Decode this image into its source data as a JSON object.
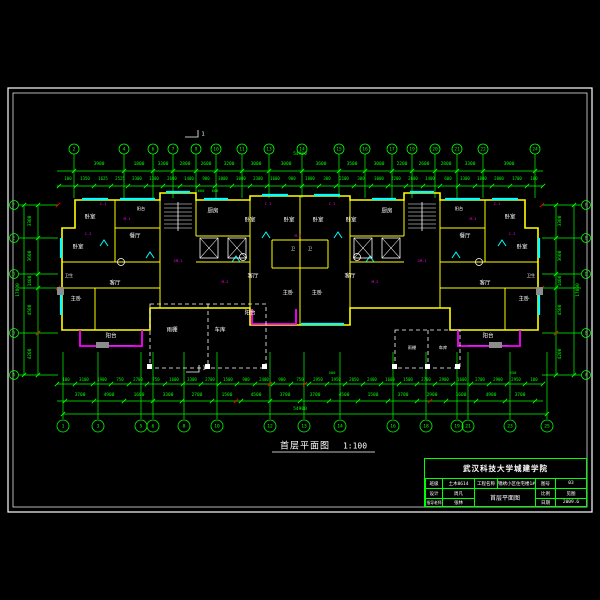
{
  "drawing_title": {
    "name": "首层平面图",
    "scale": "1:100"
  },
  "title_block": {
    "school": "武汉科技大学城建学院",
    "r1c1": "班级",
    "r1v1": "土木0614",
    "r1c2": "工程名称",
    "r1v2": "锦绣小区住宅楼1#",
    "r1c3": "图号",
    "r1v3": "03",
    "r2c1": "设计",
    "r2v1": "周凡",
    "big": "首层平面图",
    "r2c3": "比例",
    "r2v3": "见图",
    "r3c1": "指导老师",
    "r3v1": "张林",
    "r3c3": "日期",
    "r3v3": "2009.6"
  },
  "colors": {
    "axis": "#00ff00",
    "wall": "#ffff00",
    "window": "#00ffff",
    "balcony": "#ff00ff",
    "text": "#ffffff",
    "tag": "#ff00ff",
    "red": "#ff0000",
    "bg": "#000000"
  },
  "texts": [
    {
      "t": "3900",
      "x": 99,
      "y": 165
    },
    {
      "t": "1800",
      "x": 139,
      "y": 165
    },
    {
      "t": "3300",
      "x": 163,
      "y": 165
    },
    {
      "t": "2800",
      "x": 185,
      "y": 165
    },
    {
      "t": "2600",
      "x": 206,
      "y": 165
    },
    {
      "t": "3200",
      "x": 229,
      "y": 165
    },
    {
      "t": "3000",
      "x": 256,
      "y": 165
    },
    {
      "t": "3000",
      "x": 286,
      "y": 165
    },
    {
      "t": "3600",
      "x": 321,
      "y": 165
    },
    {
      "t": "3500",
      "x": 352,
      "y": 165
    },
    {
      "t": "3000",
      "x": 379,
      "y": 165
    },
    {
      "t": "2200",
      "x": 402,
      "y": 165
    },
    {
      "t": "2600",
      "x": 424,
      "y": 165
    },
    {
      "t": "2800",
      "x": 446,
      "y": 165
    },
    {
      "t": "3300",
      "x": 470,
      "y": 165
    },
    {
      "t": "3900",
      "x": 509,
      "y": 165
    },
    {
      "t": "100",
      "x": 68,
      "y": 179,
      "s": 4
    },
    {
      "t": "1350",
      "x": 85,
      "y": 179,
      "s": 4
    },
    {
      "t": "1625",
      "x": 103,
      "y": 179,
      "s": 4
    },
    {
      "t": "2525",
      "x": 120,
      "y": 179,
      "s": 4
    },
    {
      "t": "3300",
      "x": 137,
      "y": 179,
      "s": 4
    },
    {
      "t": "1300",
      "x": 154,
      "y": 179,
      "s": 4
    },
    {
      "t": "2600",
      "x": 172,
      "y": 179,
      "s": 4
    },
    {
      "t": "1400",
      "x": 189,
      "y": 179,
      "s": 4
    },
    {
      "t": "900",
      "x": 206,
      "y": 179,
      "s": 4
    },
    {
      "t": "3000",
      "x": 223,
      "y": 179,
      "s": 4
    },
    {
      "t": "3000",
      "x": 241,
      "y": 179,
      "s": 4
    },
    {
      "t": "2300",
      "x": 258,
      "y": 179,
      "s": 4
    },
    {
      "t": "1600",
      "x": 275,
      "y": 179,
      "s": 4
    },
    {
      "t": "900",
      "x": 292,
      "y": 179,
      "s": 4
    },
    {
      "t": "1800",
      "x": 310,
      "y": 179,
      "s": 4
    },
    {
      "t": "300",
      "x": 327,
      "y": 179,
      "s": 4
    },
    {
      "t": "2100",
      "x": 344,
      "y": 179,
      "s": 4
    },
    {
      "t": "300",
      "x": 361,
      "y": 179,
      "s": 4
    },
    {
      "t": "3000",
      "x": 379,
      "y": 179,
      "s": 4
    },
    {
      "t": "2200",
      "x": 396,
      "y": 179,
      "s": 4
    },
    {
      "t": "2600",
      "x": 413,
      "y": 179,
      "s": 4
    },
    {
      "t": "1400",
      "x": 430,
      "y": 179,
      "s": 4
    },
    {
      "t": "600",
      "x": 448,
      "y": 179,
      "s": 4
    },
    {
      "t": "3300",
      "x": 465,
      "y": 179,
      "s": 4
    },
    {
      "t": "1800",
      "x": 482,
      "y": 179,
      "s": 4
    },
    {
      "t": "2800",
      "x": 499,
      "y": 179,
      "s": 4
    },
    {
      "t": "1700",
      "x": 517,
      "y": 179,
      "s": 4
    },
    {
      "t": "100",
      "x": 534,
      "y": 179,
      "s": 4
    },
    {
      "t": "54900",
      "x": 300,
      "y": 155,
      "n": "total-dim"
    },
    {
      "t": "600",
      "x": 201,
      "y": 191,
      "s": 3.8
    },
    {
      "t": "600",
      "x": 215,
      "y": 191,
      "s": 3.8
    },
    {
      "t": "100",
      "x": 66,
      "y": 380,
      "s": 4
    },
    {
      "t": "3100",
      "x": 84,
      "y": 380,
      "s": 4
    },
    {
      "t": "1900",
      "x": 102,
      "y": 380,
      "s": 4
    },
    {
      "t": "750",
      "x": 120,
      "y": 380,
      "s": 4
    },
    {
      "t": "2700",
      "x": 138,
      "y": 380,
      "s": 4
    },
    {
      "t": "750",
      "x": 156,
      "y": 380,
      "s": 4
    },
    {
      "t": "1600",
      "x": 174,
      "y": 380,
      "s": 4
    },
    {
      "t": "3300",
      "x": 192,
      "y": 380,
      "s": 4
    },
    {
      "t": "2700",
      "x": 210,
      "y": 380,
      "s": 4
    },
    {
      "t": "1500",
      "x": 228,
      "y": 380,
      "s": 4
    },
    {
      "t": "900",
      "x": 246,
      "y": 380,
      "s": 4
    },
    {
      "t": "2400",
      "x": 264,
      "y": 380,
      "s": 4
    },
    {
      "t": "900",
      "x": 282,
      "y": 380,
      "s": 4
    },
    {
      "t": "750",
      "x": 300,
      "y": 380,
      "s": 4
    },
    {
      "t": "2950",
      "x": 318,
      "y": 380,
      "s": 4
    },
    {
      "t": "1950",
      "x": 336,
      "y": 380,
      "s": 4
    },
    {
      "t": "2050",
      "x": 354,
      "y": 380,
      "s": 4
    },
    {
      "t": "2400",
      "x": 372,
      "y": 380,
      "s": 4
    },
    {
      "t": "1600",
      "x": 390,
      "y": 380,
      "s": 4
    },
    {
      "t": "1500",
      "x": 408,
      "y": 380,
      "s": 4
    },
    {
      "t": "2700",
      "x": 426,
      "y": 380,
      "s": 4
    },
    {
      "t": "2900",
      "x": 444,
      "y": 380,
      "s": 4
    },
    {
      "t": "1600",
      "x": 462,
      "y": 380,
      "s": 4
    },
    {
      "t": "2700",
      "x": 480,
      "y": 380,
      "s": 4
    },
    {
      "t": "2900",
      "x": 498,
      "y": 380,
      "s": 4
    },
    {
      "t": "2950",
      "x": 516,
      "y": 380,
      "s": 4
    },
    {
      "t": "100",
      "x": 534,
      "y": 380,
      "s": 4
    },
    {
      "t": "500",
      "x": 332,
      "y": 373,
      "s": 3.8
    },
    {
      "t": "650",
      "x": 513,
      "y": 373,
      "s": 3.8
    },
    {
      "t": "3700",
      "x": 80,
      "y": 396
    },
    {
      "t": "4900",
      "x": 109,
      "y": 396
    },
    {
      "t": "1600",
      "x": 139,
      "y": 396
    },
    {
      "t": "3300",
      "x": 168,
      "y": 396
    },
    {
      "t": "2700",
      "x": 197,
      "y": 396
    },
    {
      "t": "1500",
      "x": 227,
      "y": 396
    },
    {
      "t": "4500",
      "x": 256,
      "y": 396
    },
    {
      "t": "3700",
      "x": 285,
      "y": 396
    },
    {
      "t": "3700",
      "x": 315,
      "y": 396
    },
    {
      "t": "4500",
      "x": 344,
      "y": 396
    },
    {
      "t": "1500",
      "x": 373,
      "y": 396
    },
    {
      "t": "3700",
      "x": 403,
      "y": 396
    },
    {
      "t": "2900",
      "x": 432,
      "y": 396
    },
    {
      "t": "1600",
      "x": 461,
      "y": 396
    },
    {
      "t": "4900",
      "x": 491,
      "y": 396
    },
    {
      "t": "3700",
      "x": 520,
      "y": 396
    },
    {
      "t": "54900",
      "x": 300,
      "y": 410,
      "n": "total-dim"
    },
    {
      "t": "3300",
      "x": 31,
      "y": 221,
      "r": 1
    },
    {
      "t": "3600",
      "x": 31,
      "y": 256,
      "r": 1
    },
    {
      "t": "1400",
      "x": 31,
      "y": 281,
      "r": 1
    },
    {
      "t": "4500",
      "x": 31,
      "y": 310,
      "r": 1
    },
    {
      "t": "4200",
      "x": 31,
      "y": 354,
      "r": 1
    },
    {
      "t": "17800",
      "x": 19,
      "y": 290,
      "r": 1,
      "n": "total-dim"
    },
    {
      "t": "3300",
      "x": 561,
      "y": 221,
      "r": 1
    },
    {
      "t": "3600",
      "x": 561,
      "y": 256,
      "r": 1
    },
    {
      "t": "1400",
      "x": 561,
      "y": 281,
      "r": 1
    },
    {
      "t": "4500",
      "x": 561,
      "y": 310,
      "r": 1
    },
    {
      "t": "4200",
      "x": 561,
      "y": 354,
      "r": 1
    },
    {
      "t": "17800",
      "x": 579,
      "y": 290,
      "r": 1,
      "n": "total-dim"
    },
    {
      "t": "卧室",
      "x": 90,
      "y": 218,
      "c": "w",
      "s": 5.5,
      "n": "room-label"
    },
    {
      "t": "卧室",
      "x": 78,
      "y": 248,
      "c": "w",
      "s": 5.5,
      "n": "room-label"
    },
    {
      "t": "卫生",
      "x": 69,
      "y": 276,
      "c": "w",
      "s": 4.2,
      "n": "room-label"
    },
    {
      "t": "主卧",
      "x": 76,
      "y": 300,
      "c": "w",
      "s": 5.5,
      "n": "room-label"
    },
    {
      "t": "餐厅",
      "x": 135,
      "y": 237,
      "c": "w",
      "s": 5.5,
      "n": "room-label"
    },
    {
      "t": "客厅",
      "x": 115,
      "y": 284,
      "c": "w",
      "s": 5.5,
      "n": "room-label"
    },
    {
      "t": "阳台",
      "x": 111,
      "y": 337,
      "c": "w",
      "s": 5.5,
      "n": "room-label"
    },
    {
      "t": "阳台",
      "x": 141,
      "y": 209,
      "c": "w",
      "s": 4.2,
      "n": "room-label"
    },
    {
      "t": "厨房",
      "x": 213,
      "y": 212,
      "c": "w",
      "s": 5.5,
      "n": "room-label"
    },
    {
      "t": "卧室",
      "x": 250,
      "y": 221,
      "c": "w",
      "s": 5.5,
      "n": "room-label"
    },
    {
      "t": "卧室",
      "x": 289,
      "y": 221,
      "c": "w",
      "s": 5.5,
      "n": "room-label"
    },
    {
      "t": "卧室",
      "x": 318,
      "y": 221,
      "c": "w",
      "s": 5.5,
      "n": "room-label"
    },
    {
      "t": "卧室",
      "x": 351,
      "y": 221,
      "c": "w",
      "s": 5.5,
      "n": "room-label"
    },
    {
      "t": "卫",
      "x": 293,
      "y": 249,
      "c": "w",
      "s": 4.2,
      "n": "room-label"
    },
    {
      "t": "卫",
      "x": 310,
      "y": 249,
      "c": "w",
      "s": 4.2,
      "n": "room-label"
    },
    {
      "t": "客厅",
      "x": 253,
      "y": 277,
      "c": "w",
      "s": 5.5,
      "n": "room-label"
    },
    {
      "t": "客厅",
      "x": 350,
      "y": 277,
      "c": "w",
      "s": 5.5,
      "n": "room-label"
    },
    {
      "t": "主卧",
      "x": 288,
      "y": 294,
      "c": "w",
      "s": 5.5,
      "n": "room-label"
    },
    {
      "t": "主卧",
      "x": 317,
      "y": 294,
      "c": "w",
      "s": 5.5,
      "n": "room-label"
    },
    {
      "t": "阳台",
      "x": 250,
      "y": 314,
      "c": "w",
      "s": 5.5,
      "n": "room-label"
    },
    {
      "t": "厨房",
      "x": 387,
      "y": 212,
      "c": "w",
      "s": 5.5,
      "n": "room-label"
    },
    {
      "t": "阳台",
      "x": 459,
      "y": 209,
      "c": "w",
      "s": 4.2,
      "n": "room-label"
    },
    {
      "t": "餐厅",
      "x": 465,
      "y": 237,
      "c": "w",
      "s": 5.5,
      "n": "room-label"
    },
    {
      "t": "卧室",
      "x": 510,
      "y": 218,
      "c": "w",
      "s": 5.5,
      "n": "room-label"
    },
    {
      "t": "卧室",
      "x": 522,
      "y": 248,
      "c": "w",
      "s": 5.5,
      "n": "room-label"
    },
    {
      "t": "卫生",
      "x": 531,
      "y": 276,
      "c": "w",
      "s": 4.2,
      "n": "room-label"
    },
    {
      "t": "主卧",
      "x": 524,
      "y": 300,
      "c": "w",
      "s": 5.5,
      "n": "room-label"
    },
    {
      "t": "客厅",
      "x": 485,
      "y": 284,
      "c": "w",
      "s": 5.5,
      "n": "room-label"
    },
    {
      "t": "阳台",
      "x": 488,
      "y": 337,
      "c": "w",
      "s": 5.5,
      "n": "room-label"
    },
    {
      "t": "雨棚",
      "x": 172,
      "y": 331,
      "c": "w",
      "s": 5.5,
      "n": "room-label"
    },
    {
      "t": "车库",
      "x": 220,
      "y": 331,
      "c": "w",
      "s": 5.5,
      "n": "room-label"
    },
    {
      "t": "雨棚",
      "x": 412,
      "y": 348,
      "c": "w",
      "s": 4.2,
      "n": "room-label"
    },
    {
      "t": "车库",
      "x": 443,
      "y": 348,
      "c": "w",
      "s": 4.2,
      "n": "room-label"
    },
    {
      "t": "C-1",
      "x": 103,
      "y": 204,
      "c": "m",
      "s": 3.8,
      "n": "window-tag"
    },
    {
      "t": "M-1",
      "x": 127,
      "y": 219,
      "c": "m",
      "s": 3.8,
      "n": "door-tag"
    },
    {
      "t": "C-2",
      "x": 88,
      "y": 234,
      "c": "m",
      "s": 3.8,
      "n": "window-tag"
    },
    {
      "t": "JM-1",
      "x": 178,
      "y": 261,
      "c": "m",
      "s": 3.8,
      "n": "door-tag"
    },
    {
      "t": "C-1",
      "x": 268,
      "y": 204,
      "c": "m",
      "s": 3.8,
      "n": "window-tag"
    },
    {
      "t": "C-1",
      "x": 332,
      "y": 204,
      "c": "m",
      "s": 3.8,
      "n": "window-tag"
    },
    {
      "t": "M-1",
      "x": 298,
      "y": 236,
      "c": "m",
      "s": 3.8,
      "n": "door-tag"
    },
    {
      "t": "JM-1",
      "x": 422,
      "y": 261,
      "c": "m",
      "s": 3.8,
      "n": "door-tag"
    },
    {
      "t": "C-2",
      "x": 512,
      "y": 234,
      "c": "m",
      "s": 3.8,
      "n": "window-tag"
    },
    {
      "t": "M-1",
      "x": 473,
      "y": 219,
      "c": "m",
      "s": 3.8,
      "n": "door-tag"
    },
    {
      "t": "C-1",
      "x": 497,
      "y": 204,
      "c": "m",
      "s": 3.8,
      "n": "window-tag"
    },
    {
      "t": "M-2",
      "x": 225,
      "y": 282,
      "c": "m",
      "s": 3.8,
      "n": "door-tag"
    },
    {
      "t": "M-2",
      "x": 375,
      "y": 282,
      "c": "m",
      "s": 3.8,
      "n": "door-tag"
    },
    {
      "t": "1",
      "x": 203,
      "y": 135,
      "c": "w",
      "s": 5.5,
      "n": "section-mark-label"
    },
    {
      "t": "1",
      "x": 204,
      "y": 369,
      "c": "w",
      "s": 5.5,
      "n": "section-mark-label"
    }
  ],
  "bubbles": [
    {
      "x": 74,
      "y": 149,
      "t": "2"
    },
    {
      "x": 124,
      "y": 149,
      "t": "4"
    },
    {
      "x": 153,
      "y": 149,
      "t": "6"
    },
    {
      "x": 173,
      "y": 149,
      "t": "7"
    },
    {
      "x": 196,
      "y": 149,
      "t": "9"
    },
    {
      "x": 216,
      "y": 149,
      "t": "10"
    },
    {
      "x": 242,
      "y": 149,
      "t": "11"
    },
    {
      "x": 269,
      "y": 149,
      "t": "13"
    },
    {
      "x": 302,
      "y": 149,
      "t": "14"
    },
    {
      "x": 339,
      "y": 149,
      "t": "15"
    },
    {
      "x": 365,
      "y": 149,
      "t": "16"
    },
    {
      "x": 392,
      "y": 149,
      "t": "17"
    },
    {
      "x": 412,
      "y": 149,
      "t": "19"
    },
    {
      "x": 435,
      "y": 149,
      "t": "20"
    },
    {
      "x": 457,
      "y": 149,
      "t": "21"
    },
    {
      "x": 483,
      "y": 149,
      "t": "22"
    },
    {
      "x": 535,
      "y": 149,
      "t": "24"
    },
    {
      "x": 63,
      "y": 426,
      "t": "1",
      "r": 6
    },
    {
      "x": 98,
      "y": 426,
      "t": "3",
      "r": 6
    },
    {
      "x": 141,
      "y": 426,
      "t": "5",
      "r": 6
    },
    {
      "x": 153,
      "y": 426,
      "t": "6",
      "r": 6
    },
    {
      "x": 184,
      "y": 426,
      "t": "8",
      "r": 6
    },
    {
      "x": 217,
      "y": 426,
      "t": "10",
      "r": 6
    },
    {
      "x": 270,
      "y": 426,
      "t": "12",
      "r": 6
    },
    {
      "x": 304,
      "y": 426,
      "t": "13",
      "r": 6
    },
    {
      "x": 340,
      "y": 426,
      "t": "14",
      "r": 6
    },
    {
      "x": 393,
      "y": 426,
      "t": "16",
      "r": 6
    },
    {
      "x": 426,
      "y": 426,
      "t": "18",
      "r": 6
    },
    {
      "x": 457,
      "y": 426,
      "t": "19",
      "r": 6
    },
    {
      "x": 468,
      "y": 426,
      "t": "21",
      "r": 6
    },
    {
      "x": 510,
      "y": 426,
      "t": "23",
      "r": 6
    },
    {
      "x": 547,
      "y": 426,
      "t": "25",
      "r": 6
    },
    {
      "x": 14,
      "y": 205,
      "t": "F",
      "r": 4.5
    },
    {
      "x": 14,
      "y": 238,
      "t": "E",
      "r": 4.5
    },
    {
      "x": 14,
      "y": 274,
      "t": "D",
      "r": 4.5
    },
    {
      "x": 14,
      "y": 333,
      "t": "B",
      "r": 4.5
    },
    {
      "x": 14,
      "y": 375,
      "t": "A",
      "r": 4.5
    },
    {
      "x": 586,
      "y": 205,
      "t": "F",
      "r": 4.5
    },
    {
      "x": 586,
      "y": 238,
      "t": "E",
      "r": 4.5
    },
    {
      "x": 586,
      "y": 274,
      "t": "D",
      "r": 4.5
    },
    {
      "x": 586,
      "y": 333,
      "t": "B",
      "r": 4.5
    },
    {
      "x": 586,
      "y": 375,
      "t": "A",
      "r": 4.5
    }
  ],
  "tick_lines": [
    {
      "y": 171,
      "xs": [
        74,
        124,
        153,
        173,
        196,
        216,
        242,
        269,
        302,
        339,
        365,
        392,
        412,
        435,
        457,
        483,
        535
      ]
    },
    {
      "y": 186,
      "xs": [
        59,
        76,
        94,
        111,
        128,
        146,
        163,
        180,
        198,
        215,
        232,
        250,
        267,
        284,
        302,
        319,
        336,
        354,
        371,
        388,
        406,
        423,
        440,
        458,
        475,
        492,
        510,
        527,
        543
      ]
    },
    {
      "y": 384,
      "xs": [
        57,
        75,
        93,
        111,
        129,
        147,
        165,
        183,
        201,
        219,
        237,
        255,
        273,
        291,
        309,
        327,
        345,
        363,
        381,
        399,
        417,
        435,
        453,
        471,
        489,
        507,
        525,
        543
      ]
    },
    {
      "y": 401,
      "xs": [
        65,
        94,
        124,
        153,
        182,
        212,
        241,
        270,
        300,
        329,
        358,
        388,
        417,
        446,
        476,
        505,
        535
      ]
    },
    {
      "y": 414,
      "xs": [
        63,
        547
      ]
    },
    {
      "x": 38,
      "ys": [
        205,
        238,
        274,
        288,
        333,
        375
      ]
    },
    {
      "x": 24,
      "ys": [
        205,
        375
      ]
    },
    {
      "x": 556,
      "ys": [
        205,
        238,
        274,
        288,
        333,
        375
      ]
    },
    {
      "x": 574,
      "ys": [
        205,
        375
      ]
    }
  ],
  "red_ticks": [
    [
      58,
      205
    ],
    [
      58,
      288
    ],
    [
      542,
      205
    ],
    [
      542,
      288
    ],
    [
      270,
      384
    ],
    [
      305,
      384
    ],
    [
      236,
      401
    ],
    [
      430,
      401
    ],
    [
      38,
      333
    ],
    [
      556,
      333
    ]
  ]
}
